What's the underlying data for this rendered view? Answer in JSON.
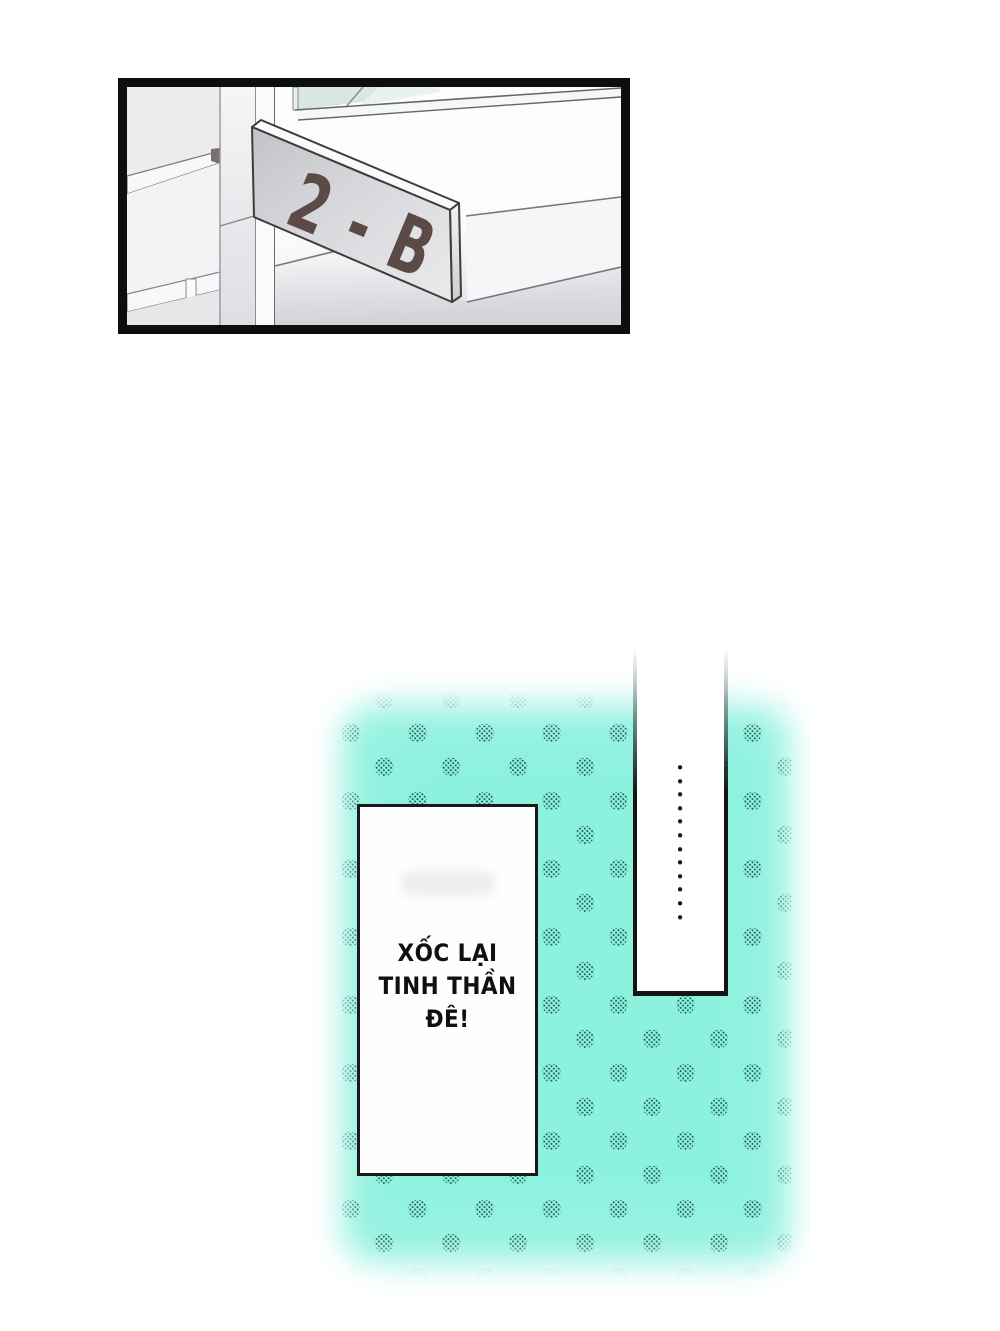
{
  "comic": {
    "panel": {
      "sign_label": "2-B",
      "description": "classroom door sign seen in perspective",
      "border_color": "#0e0e0e",
      "sign_text_color": "#5b4a45"
    },
    "speech_box": {
      "text": "XỐC LẠI\nTINH THẦN\nĐÊ!"
    },
    "pause_panel": {
      "ellipsis": "•\n•\n•\n•\n•\n•\n•\n•\n•\n•\n•\n•"
    },
    "colors": {
      "teal_glow": "#97f2e1",
      "teal_glow_core": "#8bf2dd",
      "halftone_dot": "#1c5b55",
      "ellipsis_dot": "#191919"
    }
  }
}
